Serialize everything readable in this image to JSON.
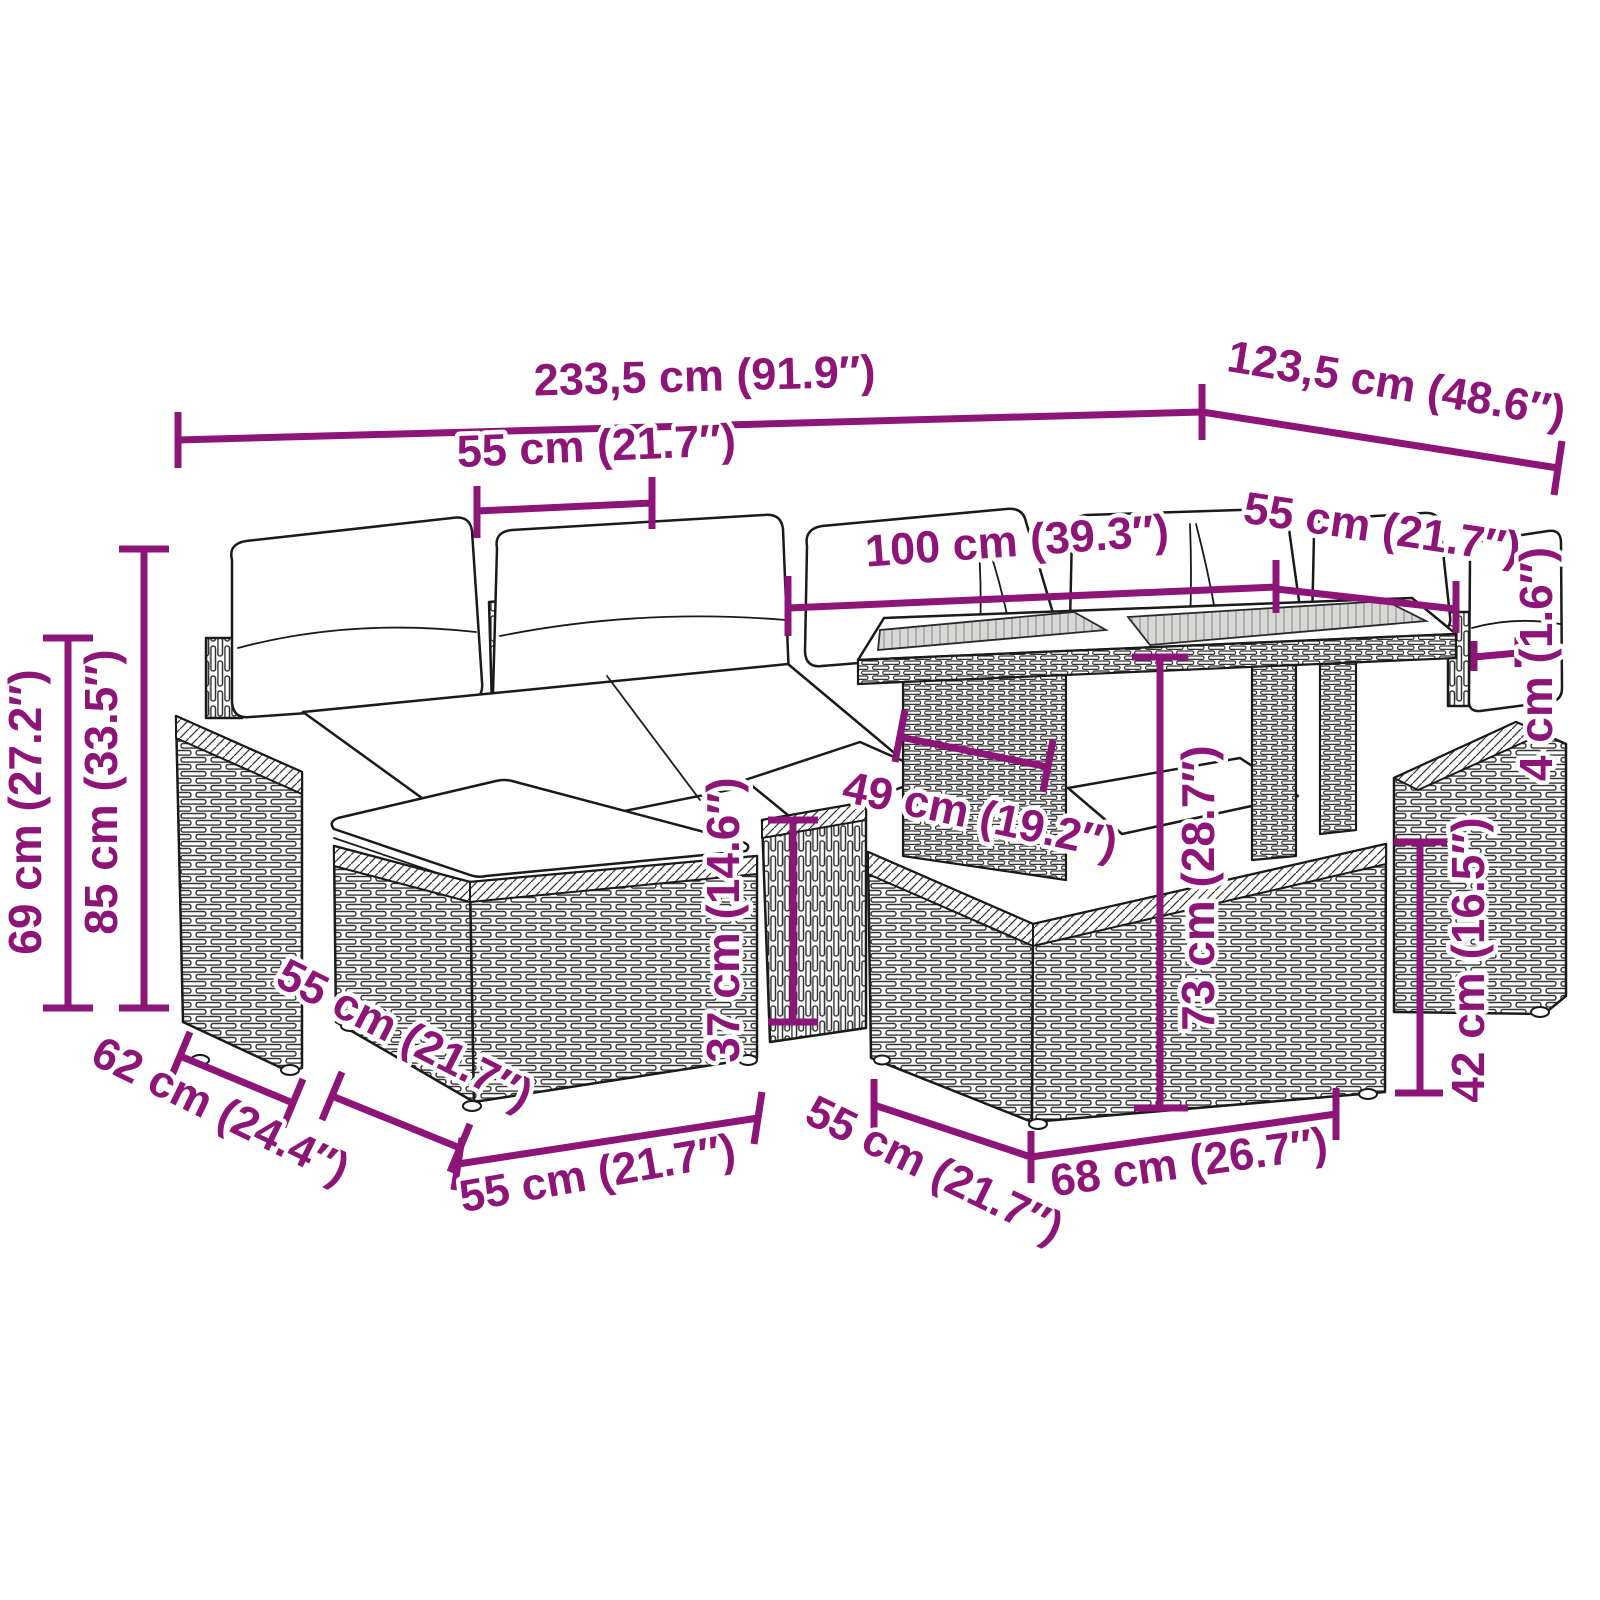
{
  "diagram": {
    "kind": "furniture-dimension-line-drawing",
    "subject": "rattan garden lounge set with cushions, table and ottomans",
    "background": "#ffffff"
  },
  "colors": {
    "dimension_accent": "#8e1578",
    "line_art": "#1a1a1a",
    "tabletop_gray": "#d7d8d6",
    "cushion_white": "#ffffff"
  },
  "dimensions": [
    {
      "id": "overall-width",
      "label": "233,5 cm (91.9″)"
    },
    {
      "id": "overall-depth",
      "label": "123,5 cm (48.6″)"
    },
    {
      "id": "seat-width-left",
      "label": "55 cm (21.7″)"
    },
    {
      "id": "table-length",
      "label": "100 cm (39.3″)"
    },
    {
      "id": "seat-width-right",
      "label": "55 cm (21.7″)"
    },
    {
      "id": "armrest-height",
      "label": "69 cm (27.2″)"
    },
    {
      "id": "back-height",
      "label": "85 cm (33.5″)"
    },
    {
      "id": "table-depth",
      "label": "49 cm (19.2″)"
    },
    {
      "id": "table-height",
      "label": "73 cm (28.7″)"
    },
    {
      "id": "seat-base-height",
      "label": "37 cm (14.6″)"
    },
    {
      "id": "tabletop-thickness",
      "label": "4 cm (1.6″)"
    },
    {
      "id": "ottoman-right-height",
      "label": "42 cm (16.5″)"
    },
    {
      "id": "armrest-depth",
      "label": "62 cm (24.4″)"
    },
    {
      "id": "ottoman-left-depth",
      "label": "55 cm (21.7″)"
    },
    {
      "id": "ottoman-left-width",
      "label": "55 cm (21.7″)"
    },
    {
      "id": "ottoman-right-depth",
      "label": "55 cm (21.7″)"
    },
    {
      "id": "ottoman-right-width",
      "label": "68 cm (26.7″)"
    }
  ]
}
